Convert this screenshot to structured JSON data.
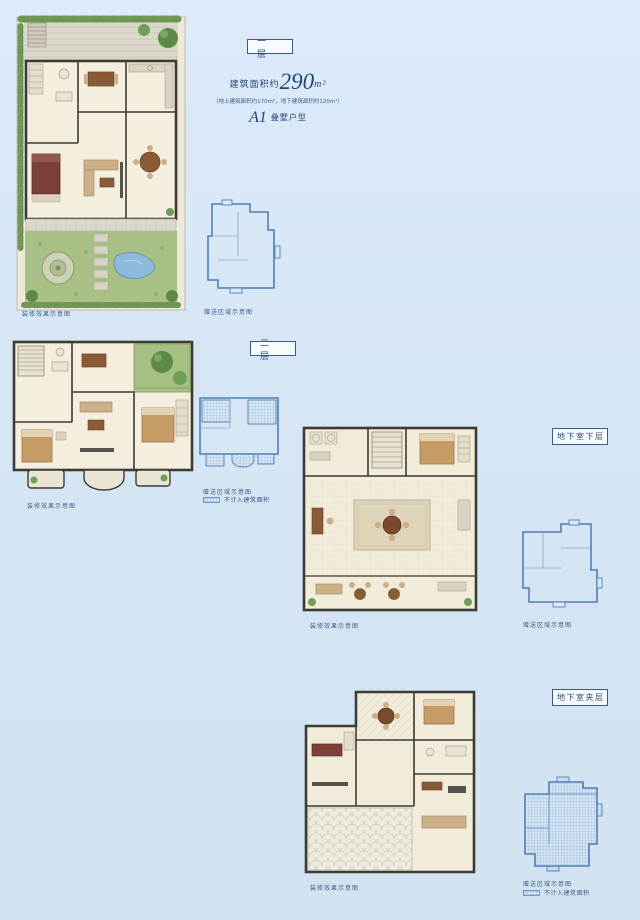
{
  "page": {
    "background": "#d7e6f4",
    "accent": "#2e4e73",
    "blueprint_color": "#4f7fb5"
  },
  "summary": {
    "area_prefix": "建筑面积约",
    "area_value": "290",
    "area_unit": "m²",
    "area_detail": "（地上建筑面积约170m²，地下建筑面积约120m²）",
    "model_code": "A1",
    "model_type": "叠墅户型"
  },
  "sections": {
    "floor1": {
      "label": "一层",
      "render_caption": "装修效果示意图",
      "gift_caption": "赠送区域示意图"
    },
    "floor2": {
      "label": "二层",
      "render_caption": "装修效果示意图",
      "gift_caption": "赠送区域示意图",
      "legend": "不计入建筑面积"
    },
    "basement_lower": {
      "label": "地下室下层",
      "render_caption": "装修效果示意图",
      "gift_caption": "赠送区域示意图"
    },
    "basement_mezzanine": {
      "label": "地下室夹层",
      "render_caption": "装修效果示意图",
      "gift_caption": "赠送区域示意图",
      "legend": "不计入建筑面积"
    }
  }
}
